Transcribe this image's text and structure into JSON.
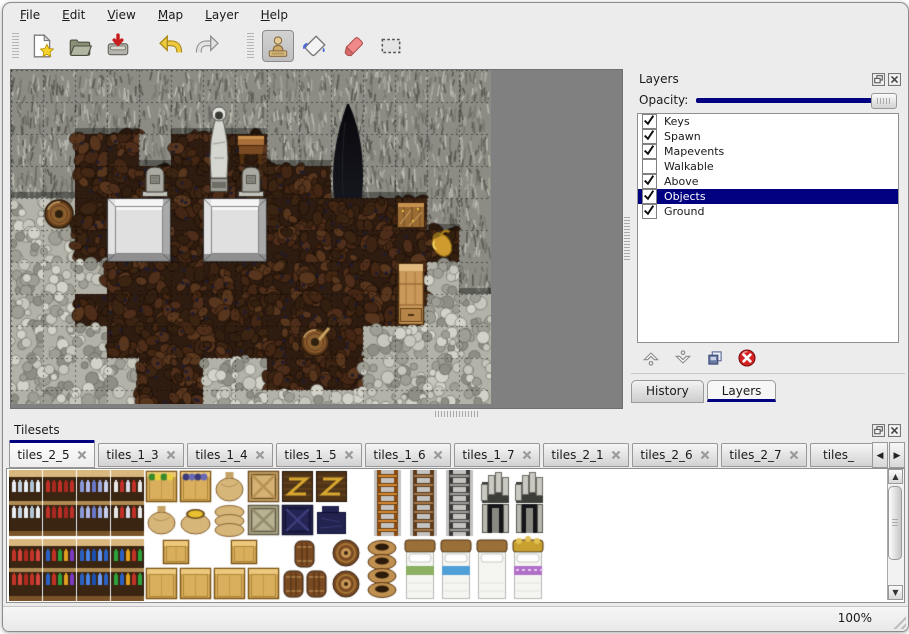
{
  "window": {
    "background": "#ececec",
    "accent": "#000080"
  },
  "menu_bar": {
    "items": [
      {
        "label": "File"
      },
      {
        "label": "Edit"
      },
      {
        "label": "View"
      },
      {
        "label": "Map"
      },
      {
        "label": "Layer"
      },
      {
        "label": "Help"
      }
    ]
  },
  "toolbar": {
    "buttons": [
      {
        "icon": "new-file-icon"
      },
      {
        "icon": "open-folder-icon"
      },
      {
        "icon": "save-icon"
      },
      {
        "icon": "undo-icon"
      },
      {
        "icon": "redo-icon"
      },
      {
        "icon": "stamp-tool-icon",
        "active": true
      },
      {
        "icon": "fill-tool-icon"
      },
      {
        "icon": "eraser-tool-icon"
      },
      {
        "icon": "select-tool-icon"
      }
    ]
  },
  "map_view": {
    "tile_size": 32,
    "grid": [
      "WWWWWWWWWWWWWWW",
      "WWWWWWWWWWWWWWW",
      "WWFFWFFFWWWWWWW",
      "WWFFFFFFFFWWWWW",
      "GGFFFFFFFFFFFWW",
      "GGFFFFFFFFFFFFW",
      "GGGFFFFFFFFFFGW",
      "GGFFFFFFFFFFFGG",
      "GGGFFFFFFFFGGGG",
      "GGGGFFGGFFFGGGG",
      "GGGGFFGGGGGGGGG"
    ],
    "objects": [
      {
        "type": "platform",
        "col": 3,
        "row": 4,
        "w": 2,
        "h": 2
      },
      {
        "type": "platform",
        "col": 6,
        "row": 4,
        "w": 2,
        "h": 2
      },
      {
        "type": "gravestone",
        "col": 4,
        "row": 3
      },
      {
        "type": "gravestone",
        "col": 7,
        "row": 3
      },
      {
        "type": "statue",
        "col": 6,
        "row": 1
      },
      {
        "type": "table",
        "col": 7,
        "row": 2
      },
      {
        "type": "darkfigure",
        "col": 10,
        "row": 1
      },
      {
        "type": "barrel",
        "col": 1,
        "row": 4
      },
      {
        "type": "crates",
        "col": 12,
        "row": 4
      },
      {
        "type": "jug",
        "col": 13,
        "row": 5
      },
      {
        "type": "cabinet",
        "col": 12,
        "row": 6
      },
      {
        "type": "barrel2",
        "col": 9,
        "row": 8
      }
    ]
  },
  "layers_panel": {
    "title": "Layers",
    "opacity_label": "Opacity:",
    "opacity_percent": 100,
    "window_icons": [
      "float-icon",
      "close-icon"
    ],
    "layers": [
      {
        "name": "Keys",
        "checked": true
      },
      {
        "name": "Spawn",
        "checked": true
      },
      {
        "name": "Mapevents",
        "checked": true
      },
      {
        "name": "Walkable",
        "checked": false
      },
      {
        "name": "Above",
        "checked": true
      },
      {
        "name": "Objects",
        "checked": true,
        "selected": true
      },
      {
        "name": "Ground",
        "checked": true
      }
    ],
    "buttons": [
      {
        "icon": "move-layer-up-icon"
      },
      {
        "icon": "move-layer-down-icon"
      },
      {
        "icon": "duplicate-layer-icon"
      },
      {
        "icon": "delete-layer-icon"
      }
    ],
    "tabs": [
      {
        "label": "History",
        "active": false
      },
      {
        "label": "Layers",
        "active": true
      }
    ]
  },
  "tilesets_panel": {
    "title": "Tilesets",
    "window_icons": [
      "float-icon",
      "close-icon"
    ],
    "tabs": [
      {
        "label": "tiles_2_5",
        "active": true
      },
      {
        "label": "tiles_1_3"
      },
      {
        "label": "tiles_1_4"
      },
      {
        "label": "tiles_1_5"
      },
      {
        "label": "tiles_1_6"
      },
      {
        "label": "tiles_1_7"
      },
      {
        "label": "tiles_2_1"
      },
      {
        "label": "tiles_2_6"
      },
      {
        "label": "tiles_2_7"
      },
      {
        "label": "tiles_",
        "clipped": true
      }
    ],
    "items": [
      {
        "t": "shelf",
        "x": 0,
        "y": 0,
        "w": 33,
        "h": 66,
        "v": 0
      },
      {
        "t": "shelf",
        "x": 34,
        "y": 0,
        "w": 33,
        "h": 66,
        "v": 1
      },
      {
        "t": "shelf",
        "x": 68,
        "y": 0,
        "w": 33,
        "h": 66,
        "v": 2
      },
      {
        "t": "shelf",
        "x": 102,
        "y": 0,
        "w": 33,
        "h": 66,
        "v": 3
      },
      {
        "t": "cratetop",
        "x": 136,
        "y": 0,
        "w": 33,
        "h": 33,
        "v": "veg"
      },
      {
        "t": "cratetop",
        "x": 170,
        "y": 0,
        "w": 33,
        "h": 33,
        "v": "grape"
      },
      {
        "t": "sack",
        "x": 204,
        "y": 0,
        "w": 33,
        "h": 33
      },
      {
        "t": "cratex",
        "x": 238,
        "y": 0,
        "w": 33,
        "h": 33,
        "v": "light"
      },
      {
        "t": "plankz",
        "x": 272,
        "y": 0,
        "w": 33,
        "h": 33
      },
      {
        "t": "plankz",
        "x": 306,
        "y": 0,
        "w": 33,
        "h": 33
      },
      {
        "t": "sack",
        "x": 136,
        "y": 34,
        "w": 33,
        "h": 32
      },
      {
        "t": "sackopen",
        "x": 170,
        "y": 34,
        "w": 33,
        "h": 32
      },
      {
        "t": "sackstack",
        "x": 204,
        "y": 34,
        "w": 33,
        "h": 32
      },
      {
        "t": "cratex",
        "x": 238,
        "y": 34,
        "w": 33,
        "h": 32,
        "v": "gray"
      },
      {
        "t": "cratex",
        "x": 272,
        "y": 34,
        "w": 33,
        "h": 32,
        "v": "navy"
      },
      {
        "t": "navypile",
        "x": 306,
        "y": 34,
        "w": 33,
        "h": 32
      },
      {
        "t": "ladder",
        "x": 362,
        "y": 0,
        "w": 33,
        "h": 66,
        "v": "orange"
      },
      {
        "t": "ladder",
        "x": 398,
        "y": 0,
        "w": 33,
        "h": 66,
        "v": "brown"
      },
      {
        "t": "ladder",
        "x": 434,
        "y": 0,
        "w": 33,
        "h": 66,
        "v": "gray"
      },
      {
        "t": "archtop",
        "x": 470,
        "y": 0,
        "w": 33,
        "h": 33
      },
      {
        "t": "archtop",
        "x": 504,
        "y": 0,
        "w": 33,
        "h": 33
      },
      {
        "t": "archbottom",
        "x": 470,
        "y": 34,
        "w": 33,
        "h": 32
      },
      {
        "t": "archbottom",
        "x": 504,
        "y": 34,
        "w": 33,
        "h": 32
      },
      {
        "t": "shelf",
        "x": 0,
        "y": 69,
        "w": 33,
        "h": 62,
        "v": 4
      },
      {
        "t": "shelf",
        "x": 34,
        "y": 69,
        "w": 33,
        "h": 62,
        "v": 5
      },
      {
        "t": "shelf",
        "x": 68,
        "y": 69,
        "w": 33,
        "h": 62,
        "v": 6
      },
      {
        "t": "shelf",
        "x": 102,
        "y": 69,
        "w": 33,
        "h": 62,
        "v": 7
      },
      {
        "t": "box",
        "x": 153,
        "y": 69,
        "w": 28,
        "h": 26
      },
      {
        "t": "box",
        "x": 221,
        "y": 69,
        "w": 28,
        "h": 26
      },
      {
        "t": "box",
        "x": 136,
        "y": 97,
        "w": 33,
        "h": 33
      },
      {
        "t": "box",
        "x": 170,
        "y": 97,
        "w": 33,
        "h": 33
      },
      {
        "t": "box",
        "x": 204,
        "y": 97,
        "w": 33,
        "h": 33
      },
      {
        "t": "box",
        "x": 238,
        "y": 97,
        "w": 33,
        "h": 33
      },
      {
        "t": "barrelcluster",
        "x": 274,
        "y": 69,
        "w": 46,
        "h": 61
      },
      {
        "t": "barrelfront",
        "x": 322,
        "y": 69,
        "w": 30,
        "h": 29
      },
      {
        "t": "barrelfront",
        "x": 322,
        "y": 100,
        "w": 30,
        "h": 29
      },
      {
        "t": "potstack",
        "x": 356,
        "y": 69,
        "w": 34,
        "h": 62
      },
      {
        "t": "bed",
        "x": 394,
        "y": 69,
        "w": 34,
        "h": 62,
        "v": "green"
      },
      {
        "t": "bed",
        "x": 430,
        "y": 69,
        "w": 34,
        "h": 62,
        "v": "blue"
      },
      {
        "t": "bed",
        "x": 466,
        "y": 69,
        "w": 34,
        "h": 62,
        "v": "white"
      },
      {
        "t": "bed",
        "x": 502,
        "y": 69,
        "w": 34,
        "h": 62,
        "v": "purple"
      }
    ]
  },
  "status_bar": {
    "zoom_level": "100%"
  }
}
